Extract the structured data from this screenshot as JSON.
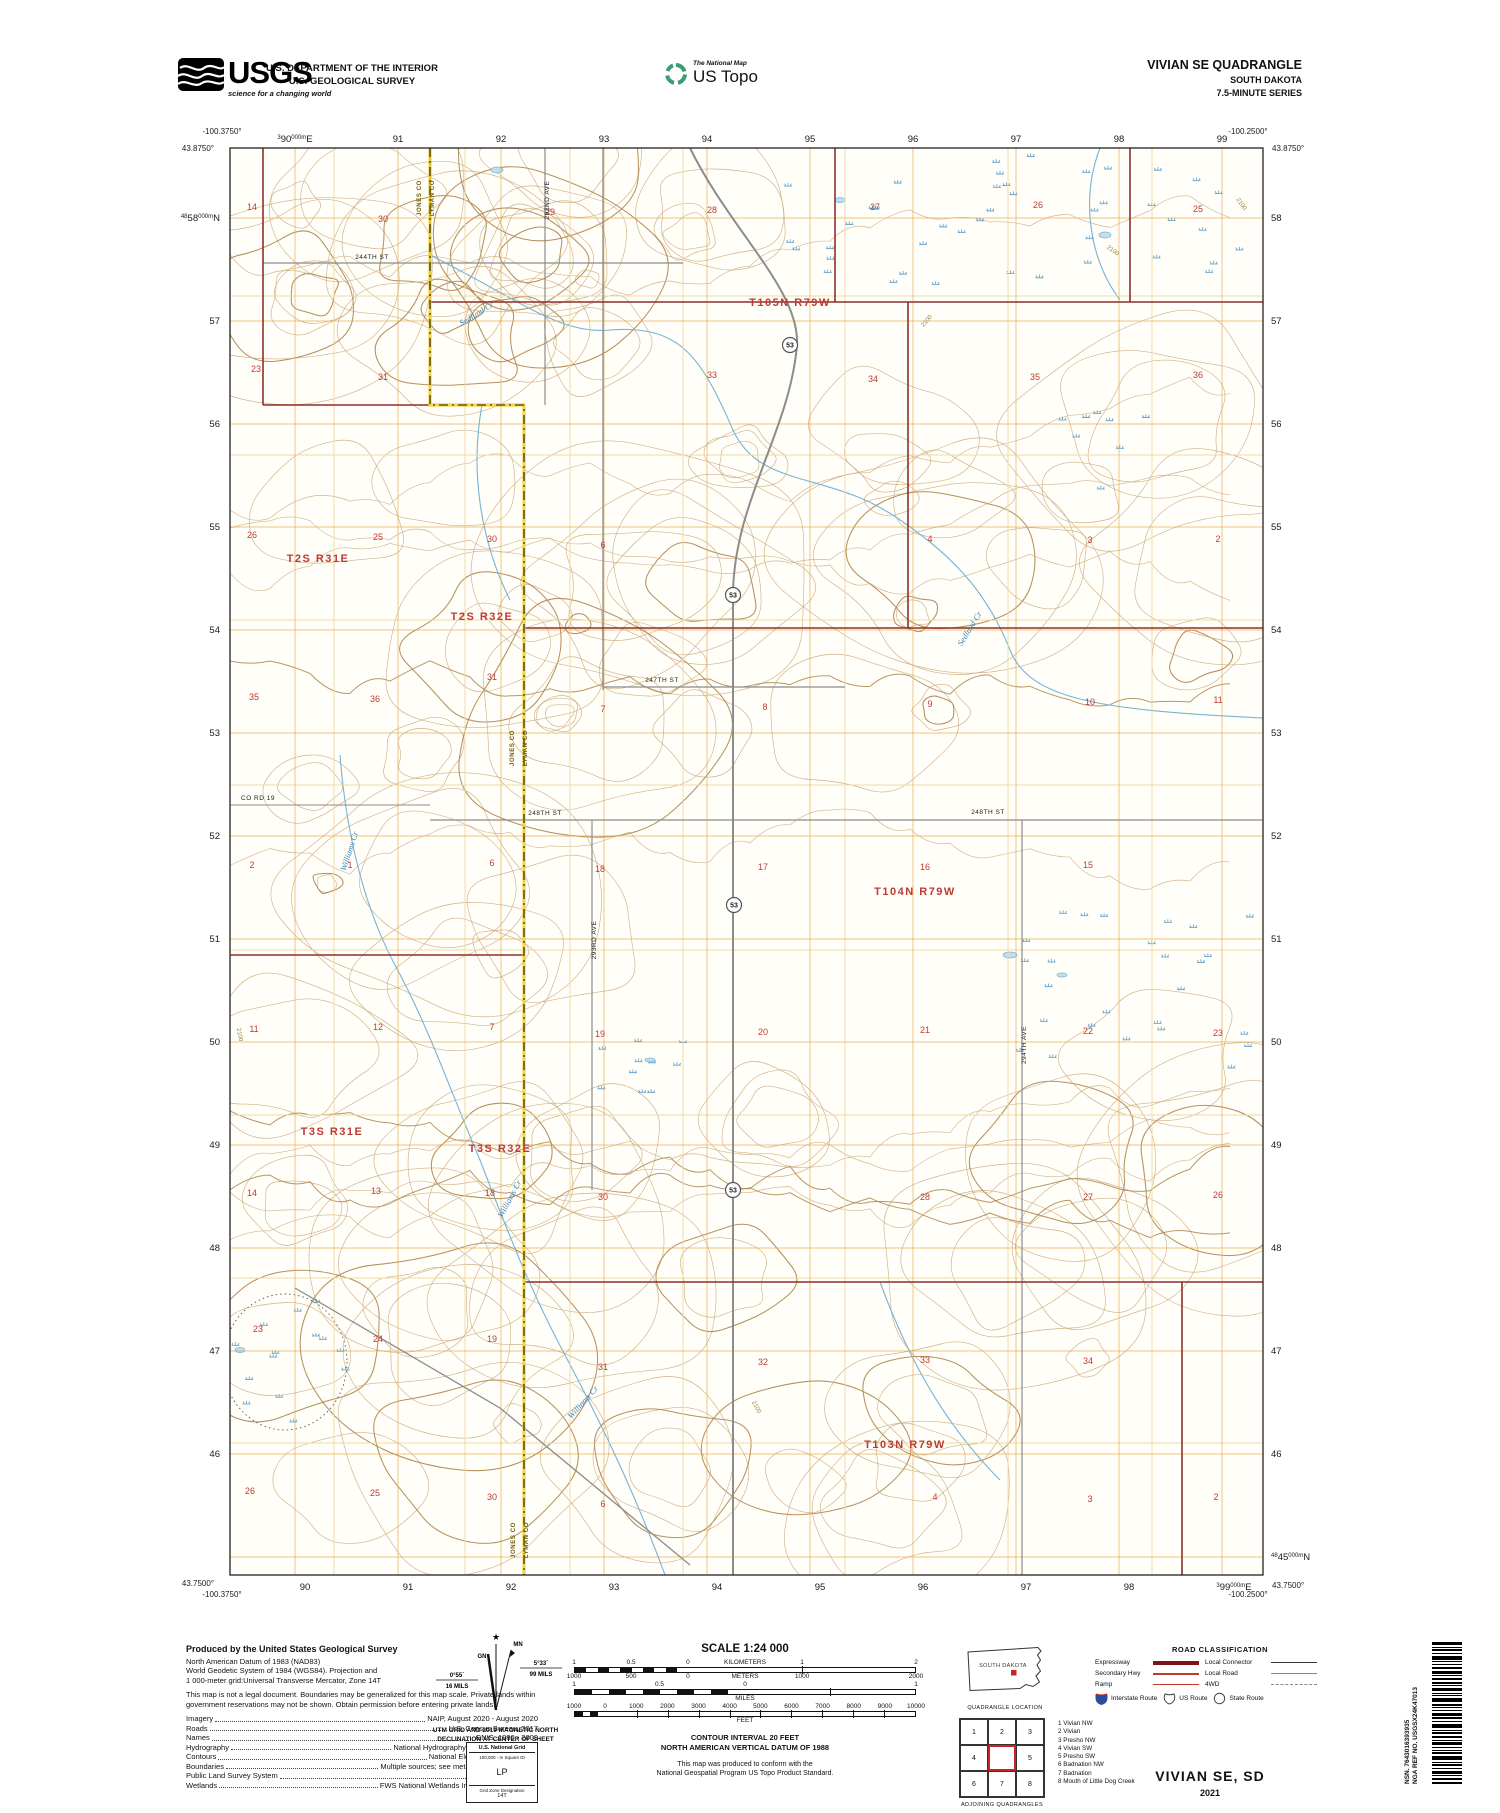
{
  "header": {
    "usgs_logo_text": "USGS",
    "usgs_tagline": "science for a changing world",
    "agency_line1": "U.S. DEPARTMENT OF THE INTERIOR",
    "agency_line2": "U.S. GEOLOGICAL SURVEY",
    "ustopo_brand_top": "The National Map",
    "ustopo_brand": "US Topo",
    "quad_title": "VIVIAN SE QUADRANGLE",
    "quad_state": "SOUTH DAKOTA",
    "quad_series": "7.5-MINUTE SERIES"
  },
  "map": {
    "corners": {
      "tl_lon": "-100.3750°",
      "tl_lat": "43.8750°",
      "tr_lon": "-100.2500°",
      "tr_lat": "43.8750°",
      "bl_lat": "43.7500°",
      "bl_lon": "-100.3750°",
      "br_lon": "-100.2500°",
      "br_lat": "43.7500°"
    },
    "grid": {
      "top": {
        "first": {
          "sup": "3",
          "main": "90",
          "mid": "000m",
          "suf": "E"
        },
        "rest": [
          "91",
          "92",
          "93",
          "94",
          "95",
          "96",
          "97",
          "98",
          "99"
        ]
      },
      "bottom": {
        "rest": [
          "90",
          "91",
          "92",
          "93",
          "94",
          "95",
          "96",
          "97",
          "98"
        ],
        "last": {
          "sup": "3",
          "main": "99",
          "mid": "000m",
          "suf": "E"
        }
      },
      "left": {
        "first": {
          "sup": "48",
          "main": "58",
          "mid": "000m",
          "suf": "N"
        },
        "rest": [
          "57",
          "56",
          "55",
          "54",
          "53",
          "52",
          "51",
          "50",
          "49",
          "48",
          "47",
          "46"
        ]
      },
      "right": {
        "rest": [
          "58",
          "57",
          "56",
          "55",
          "54",
          "53",
          "52",
          "51",
          "50",
          "49",
          "48",
          "47",
          "46"
        ],
        "last": {
          "sup": "48",
          "main": "45",
          "mid": "000m",
          "suf": "N"
        }
      }
    },
    "townships": [
      {
        "t": "T105N R79W",
        "x": 790,
        "y": 306
      },
      {
        "t": "T2S R31E",
        "x": 318,
        "y": 562
      },
      {
        "t": "T2S R32E",
        "x": 482,
        "y": 620
      },
      {
        "t": "T104N R79W",
        "x": 915,
        "y": 895
      },
      {
        "t": "T3S R31E",
        "x": 332,
        "y": 1135
      },
      {
        "t": "T3S R32E",
        "x": 500,
        "y": 1152
      },
      {
        "t": "T103N R79W",
        "x": 905,
        "y": 1448
      }
    ],
    "sections": [
      {
        "n": "14",
        "x": 252,
        "y": 210
      },
      {
        "n": "30",
        "x": 383,
        "y": 222
      },
      {
        "n": "29",
        "x": 550,
        "y": 215
      },
      {
        "n": "28",
        "x": 712,
        "y": 213
      },
      {
        "n": "27",
        "x": 875,
        "y": 210
      },
      {
        "n": "26",
        "x": 1038,
        "y": 208
      },
      {
        "n": "25",
        "x": 1198,
        "y": 212
      },
      {
        "n": "23",
        "x": 256,
        "y": 372
      },
      {
        "n": "31",
        "x": 383,
        "y": 380
      },
      {
        "n": "33",
        "x": 712,
        "y": 378
      },
      {
        "n": "34",
        "x": 873,
        "y": 382
      },
      {
        "n": "35",
        "x": 1035,
        "y": 380
      },
      {
        "n": "36",
        "x": 1198,
        "y": 378
      },
      {
        "n": "26",
        "x": 252,
        "y": 538
      },
      {
        "n": "25",
        "x": 378,
        "y": 540
      },
      {
        "n": "30",
        "x": 492,
        "y": 542
      },
      {
        "n": "6",
        "x": 603,
        "y": 548
      },
      {
        "n": "4",
        "x": 930,
        "y": 542
      },
      {
        "n": "3",
        "x": 1090,
        "y": 543
      },
      {
        "n": "2",
        "x": 1218,
        "y": 542
      },
      {
        "n": "35",
        "x": 254,
        "y": 700
      },
      {
        "n": "36",
        "x": 375,
        "y": 702
      },
      {
        "n": "31",
        "x": 492,
        "y": 680
      },
      {
        "n": "7",
        "x": 603,
        "y": 712
      },
      {
        "n": "8",
        "x": 765,
        "y": 710
      },
      {
        "n": "9",
        "x": 930,
        "y": 707
      },
      {
        "n": "10",
        "x": 1090,
        "y": 705
      },
      {
        "n": "11",
        "x": 1218,
        "y": 703
      },
      {
        "n": "2",
        "x": 252,
        "y": 868
      },
      {
        "n": "1",
        "x": 350,
        "y": 868
      },
      {
        "n": "6",
        "x": 492,
        "y": 866
      },
      {
        "n": "18",
        "x": 600,
        "y": 872
      },
      {
        "n": "17",
        "x": 763,
        "y": 870
      },
      {
        "n": "16",
        "x": 925,
        "y": 870
      },
      {
        "n": "15",
        "x": 1088,
        "y": 868
      },
      {
        "n": "11",
        "x": 254,
        "y": 1032
      },
      {
        "n": "12",
        "x": 378,
        "y": 1030
      },
      {
        "n": "7",
        "x": 492,
        "y": 1030
      },
      {
        "n": "19",
        "x": 600,
        "y": 1037
      },
      {
        "n": "20",
        "x": 763,
        "y": 1035
      },
      {
        "n": "21",
        "x": 925,
        "y": 1033
      },
      {
        "n": "22",
        "x": 1088,
        "y": 1034
      },
      {
        "n": "23",
        "x": 1218,
        "y": 1036
      },
      {
        "n": "14",
        "x": 252,
        "y": 1196
      },
      {
        "n": "13",
        "x": 376,
        "y": 1194
      },
      {
        "n": "18",
        "x": 490,
        "y": 1196
      },
      {
        "n": "30",
        "x": 603,
        "y": 1200
      },
      {
        "n": "28",
        "x": 925,
        "y": 1200
      },
      {
        "n": "27",
        "x": 1088,
        "y": 1200
      },
      {
        "n": "26",
        "x": 1218,
        "y": 1198
      },
      {
        "n": "23",
        "x": 258,
        "y": 1332
      },
      {
        "n": "24",
        "x": 378,
        "y": 1342
      },
      {
        "n": "19",
        "x": 492,
        "y": 1342
      },
      {
        "n": "31",
        "x": 603,
        "y": 1370
      },
      {
        "n": "32",
        "x": 763,
        "y": 1365
      },
      {
        "n": "33",
        "x": 925,
        "y": 1363
      },
      {
        "n": "34",
        "x": 1088,
        "y": 1364
      },
      {
        "n": "26",
        "x": 250,
        "y": 1494
      },
      {
        "n": "25",
        "x": 375,
        "y": 1496
      },
      {
        "n": "30",
        "x": 492,
        "y": 1500
      },
      {
        "n": "6",
        "x": 603,
        "y": 1507
      },
      {
        "n": "4",
        "x": 935,
        "y": 1500
      },
      {
        "n": "3",
        "x": 1090,
        "y": 1502
      },
      {
        "n": "2",
        "x": 1216,
        "y": 1500
      }
    ],
    "road_labels": [
      {
        "t": "244TH ST",
        "x": 372,
        "y": 259
      },
      {
        "t": "247TH ST",
        "x": 662,
        "y": 682
      },
      {
        "t": "248TH ST",
        "x": 545,
        "y": 815
      },
      {
        "t": "248TH ST",
        "x": 988,
        "y": 814
      },
      {
        "t": "CO RD 19",
        "x": 258,
        "y": 800
      }
    ],
    "ave_labels": [
      {
        "t": "292ND AVE",
        "x": 549,
        "y": 200
      },
      {
        "t": "293RD AVE",
        "x": 596,
        "y": 940
      },
      {
        "t": "294TH AVE",
        "x": 1026,
        "y": 1045
      }
    ],
    "creek_labels": [
      {
        "t": "Sedlund Cr",
        "x": 478,
        "y": 316,
        "r": -32
      },
      {
        "t": "Sedlund Cr",
        "x": 972,
        "y": 630,
        "r": -58
      },
      {
        "t": "Williams Cr",
        "x": 352,
        "y": 852,
        "r": -72
      },
      {
        "t": "Williams Cr",
        "x": 512,
        "y": 1200,
        "r": -62
      },
      {
        "t": "Williams Cr",
        "x": 585,
        "y": 1404,
        "r": -48
      }
    ],
    "county_labels": {
      "left": "JONES CO",
      "right": "LYMAN CO",
      "positions": [
        {
          "x": 427,
          "y": 198
        },
        {
          "x": 520,
          "y": 748
        },
        {
          "x": 521,
          "y": 1540
        }
      ]
    },
    "route_markers": {
      "label": "53",
      "positions": [
        {
          "x": 790,
          "y": 345
        },
        {
          "x": 733,
          "y": 595
        },
        {
          "x": 734,
          "y": 905
        },
        {
          "x": 733,
          "y": 1190
        }
      ]
    },
    "contour_labels": {
      "label": "2100",
      "positions": [
        {
          "x": 928,
          "y": 322,
          "r": -50
        },
        {
          "x": 1112,
          "y": 252,
          "r": 35
        },
        {
          "x": 1240,
          "y": 205,
          "r": 55
        },
        {
          "x": 755,
          "y": 1408,
          "r": 60
        },
        {
          "x": 238,
          "y": 1035,
          "r": 80
        }
      ]
    }
  },
  "footer": {
    "produced": {
      "title": "Produced by the United States Geological Survey",
      "datum_lines": [
        "North American Datum of 1983 (NAD83)",
        "World Geodetic System of 1984 (WGS84).  Projection and",
        "1 000-meter grid:Universal Transverse Mercator, Zone 14T"
      ],
      "legal": "This map is not a legal document. Boundaries may be generalized for this map scale. Private lands within government reservations may not be shown. Obtain permission before entering private lands.",
      "credits": [
        {
          "label": "Imagery",
          "value": "NAIP, August 2020 - August 2020"
        },
        {
          "label": "Roads",
          "value": "U.S. Census Bureau, 2017"
        },
        {
          "label": "Names",
          "value": "GNIS, 1986 - 2009"
        },
        {
          "label": "Hydrography",
          "value": "National Hydrography Dataset, 2005 - 2019"
        },
        {
          "label": "Contours",
          "value": "National Elevation Dataset, 2019"
        },
        {
          "label": "Boundaries",
          "value": "Multiple sources; see metadata file 2019 - 2021"
        },
        {
          "label": "Public Land Survey System",
          "value": "BLM, 2017"
        },
        {
          "label": "Wetlands",
          "value": "FWS National Wetlands Inventory Not Available"
        }
      ]
    },
    "declination": {
      "star": "★",
      "gn_label": "GN",
      "mn_label": "MN",
      "gn_value": "0°55´",
      "gn_mils": "16 MILS",
      "mn_value": "5°33´",
      "mn_mils": "99 MILS",
      "caption_1": "UTM GRID AND 2019 MAGNETIC NORTH",
      "caption_2": "DECLINATION AT CENTER OF SHEET"
    },
    "usng": {
      "title": "U.S. National Grid",
      "sub": "100,000 - m Square ID",
      "square": "LP",
      "zone_label": "Grid Zone Designation",
      "zone": "14T"
    },
    "scale": {
      "title": "SCALE 1:24 000",
      "bars": [
        {
          "top": [
            {
              "t": "1",
              "p": 0
            },
            {
              "t": "0.5",
              "p": 16.7
            },
            {
              "t": "0",
              "p": 33.3
            },
            {
              "t": "KILOMETERS",
              "p": 50
            },
            {
              "t": "1",
              "p": 66.7
            },
            {
              "t": "2",
              "p": 100
            }
          ],
          "bottom": [
            {
              "t": "1000",
              "p": 0
            },
            {
              "t": "500",
              "p": 16.7
            },
            {
              "t": "0",
              "p": 33.3
            },
            {
              "t": "METERS",
              "p": 50
            },
            {
              "t": "1000",
              "p": 66.7
            },
            {
              "t": "2000",
              "p": 100
            }
          ],
          "alt": 33.3,
          "cells": 10,
          "ticks": [
            66.7
          ]
        },
        {
          "top": [
            {
              "t": "1",
              "p": 0
            },
            {
              "t": "0.5",
              "p": 25
            },
            {
              "t": "0",
              "p": 50
            },
            {
              "t": "1",
              "p": 100
            }
          ],
          "bottom": [
            {
              "t": "MILES",
              "p": 50
            }
          ],
          "alt": 50,
          "cells": 10,
          "ticks": [
            75
          ]
        },
        {
          "top": [
            {
              "t": "1000",
              "p": 0
            },
            {
              "t": "0",
              "p": 9.1
            },
            {
              "t": "1000",
              "p": 18.2
            },
            {
              "t": "2000",
              "p": 27.3
            },
            {
              "t": "3000",
              "p": 36.4
            },
            {
              "t": "4000",
              "p": 45.5
            },
            {
              "t": "5000",
              "p": 54.5
            },
            {
              "t": "6000",
              "p": 63.6
            },
            {
              "t": "7000",
              "p": 72.7
            },
            {
              "t": "8000",
              "p": 81.8
            },
            {
              "t": "9000",
              "p": 90.9
            },
            {
              "t": "10000",
              "p": 100
            }
          ],
          "bottom": [
            {
              "t": "FEET",
              "p": 50
            }
          ],
          "alt": 9.1,
          "cells": 4,
          "ticks": [
            18.2,
            27.3,
            36.4,
            45.5,
            54.5,
            63.6,
            72.7,
            81.8,
            90.9
          ]
        }
      ],
      "contour_note_1": "CONTOUR INTERVAL 20 FEET",
      "contour_note_2": "NORTH AMERICAN VERTICAL DATUM OF 1988",
      "conform_1": "This map was produced to conform with the",
      "conform_2": "National Geospatial Program US Topo Product Standard."
    },
    "location": {
      "state_label": "SOUTH DAKOTA",
      "caption": "QUADRANGLE LOCATION"
    },
    "adjoining": {
      "caption": "ADJOINING QUADRANGLES",
      "cells": [
        "1",
        "2",
        "3",
        "4",
        "",
        "5",
        "6",
        "7",
        "8"
      ],
      "list": [
        "1 Vivian NW",
        "2 Vivian",
        "3 Presho NW",
        "4 Vivian SW",
        "5 Presho SW",
        "6 Badnation NW",
        "7 Badnation",
        "8 Mouth of Little Dog Creek"
      ]
    },
    "roadclass": {
      "title": "ROAD CLASSIFICATION",
      "rows": [
        {
          "l": "Expressway",
          "ls": "exp",
          "r": "Local Connector",
          "rs": "lc"
        },
        {
          "l": "Secondary Hwy",
          "ls": "sec2",
          "r": "Local Road",
          "rs": "lr"
        },
        {
          "l": "Ramp",
          "ls": "ramp",
          "r": "4WD",
          "rs": "fwd"
        }
      ],
      "shields": [
        {
          "t": "Interstate Route",
          "k": "is"
        },
        {
          "t": "US Route",
          "k": "us"
        },
        {
          "t": "State Route",
          "k": "sr"
        }
      ]
    },
    "barcode": {
      "line1": "NSN.  7643016393935",
      "line2": "NGA REF NO.  USGSX24K47013"
    },
    "title_block": {
      "name": "VIVIAN SE,  SD",
      "year": "2021"
    }
  }
}
